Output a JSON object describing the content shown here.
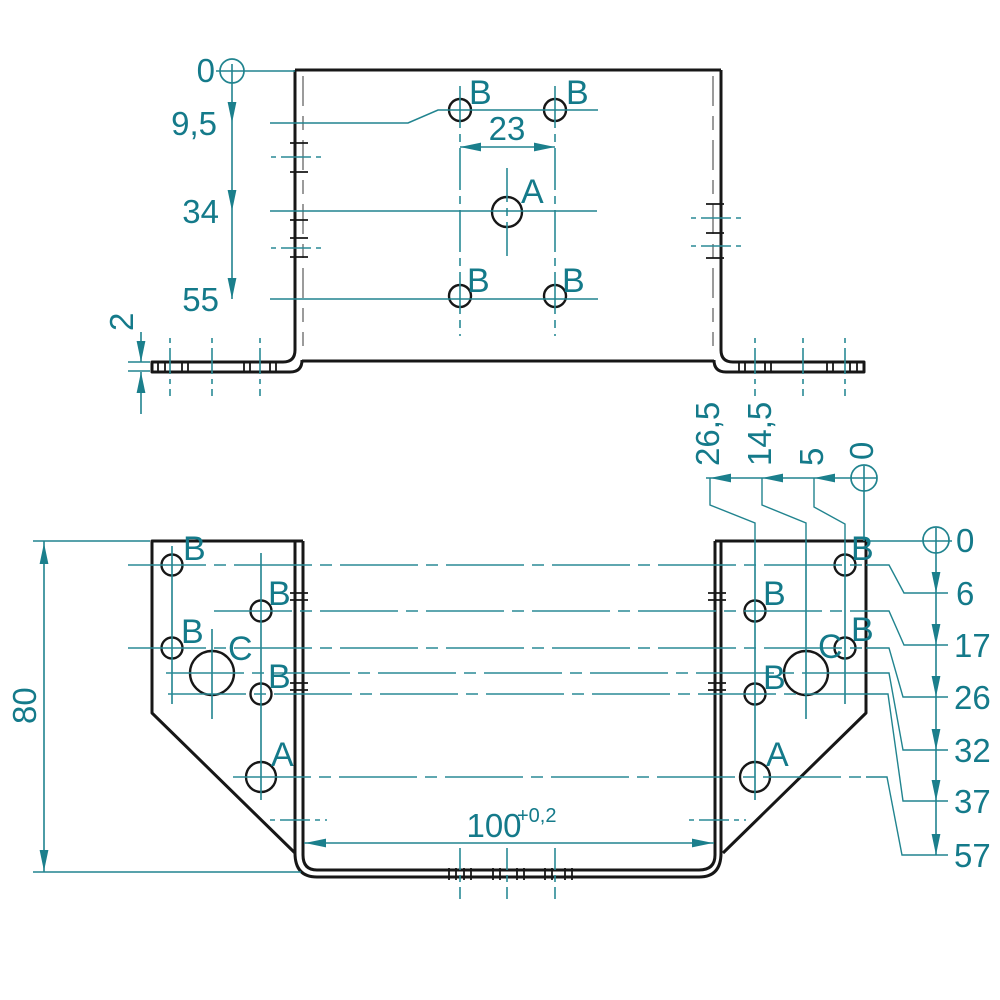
{
  "drawing_type": "technical-drawing-sheet-metal-bracket",
  "colors": {
    "outline": "#171717",
    "dimension_lines": "#21848F",
    "dimension_text": "#147A8A",
    "hidden_lines": "#9b9b9b",
    "background": "#ffffff"
  },
  "labels": {
    "hole_a": "A",
    "hole_b": "B",
    "hole_c": "C"
  },
  "front_view": {
    "datum": "0",
    "offset_9_5": "9,5",
    "offset_34": "34",
    "offset_55": "55",
    "hole_spacing": "23",
    "thickness": "2"
  },
  "plan_view": {
    "height": "80",
    "width": "100",
    "width_tolerance": "+0,2",
    "col_datum": "0",
    "col_5": "5",
    "col_14_5": "14,5",
    "col_26_5": "26,5",
    "row_datum": "0",
    "row_6": "6",
    "row_17": "17",
    "row_26": "26",
    "row_32": "32",
    "row_37": "37",
    "row_57": "57"
  }
}
